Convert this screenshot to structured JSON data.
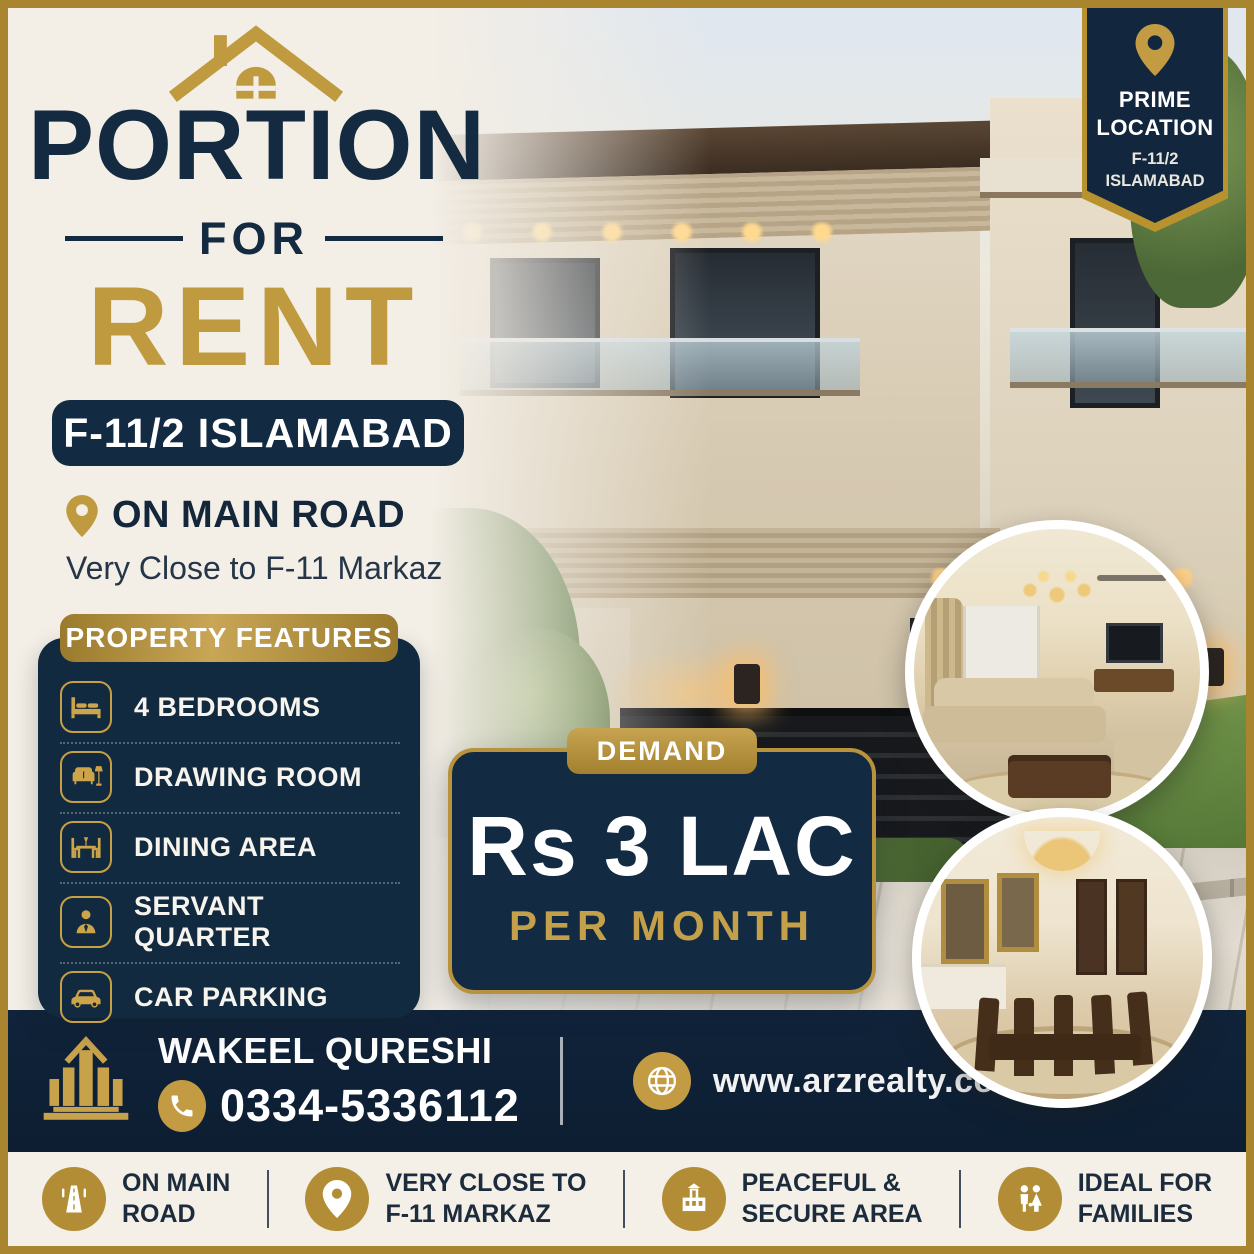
{
  "poster": {
    "title_top": "PORTION",
    "title_mid": "FOR",
    "title_bottom": "RENT",
    "location_badge": "F-11/2 ISLAMABAD",
    "on_main_road": "ON MAIN ROAD",
    "subtitle": "Very Close to F-11 Markaz"
  },
  "prime_ribbon": {
    "line1": "PRIME",
    "line2": "LOCATION",
    "line3": "F-11/2",
    "line4": "ISLAMABAD"
  },
  "features": {
    "header": "PROPERTY FEATURES",
    "items": [
      {
        "icon": "bed-icon",
        "label": "4 BEDROOMS"
      },
      {
        "icon": "sofa-icon",
        "label": "DRAWING ROOM"
      },
      {
        "icon": "dining-icon",
        "label": "DINING AREA"
      },
      {
        "icon": "person-icon",
        "label": "SERVANT QUARTER"
      },
      {
        "icon": "car-icon",
        "label": "CAR PARKING"
      }
    ]
  },
  "demand": {
    "badge": "DEMAND",
    "price": "Rs 3 LAC",
    "period": "PER MONTH"
  },
  "contact": {
    "name": "WAKEEL QURESHI",
    "phone": "0334-5336112",
    "website": "www.arzrealty.com"
  },
  "highlights": [
    {
      "icon": "road-icon",
      "line1": "ON MAIN",
      "line2": "ROAD"
    },
    {
      "icon": "pin-icon",
      "line1": "VERY CLOSE TO",
      "line2": "F-11 MARKAZ"
    },
    {
      "icon": "building-icon",
      "line1": "PEACEFUL &",
      "line2": "SECURE AREA"
    },
    {
      "icon": "family-icon",
      "line1": "IDEAL FOR",
      "line2": "FAMILIES"
    }
  ],
  "colors": {
    "navy": "#132a40",
    "gold": "#bf9a3f",
    "cream": "#f3eee6",
    "white": "#ffffff"
  }
}
